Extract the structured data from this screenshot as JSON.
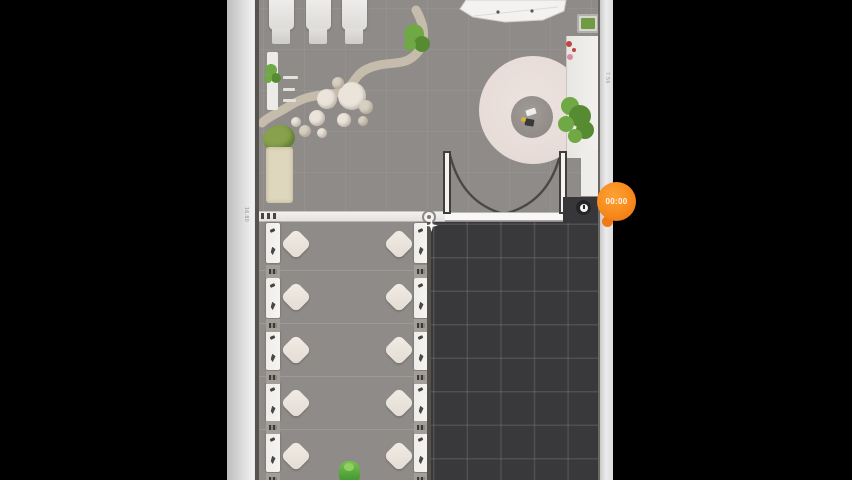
{
  "scene": {
    "name": "spa-salon-floor-plan"
  },
  "timer_badge": {
    "label": "00:00",
    "color": "#f88a1c",
    "color_dark": "#e96d10"
  },
  "dimensions": {
    "left_wall": "16.80",
    "right_wall": "7.56"
  },
  "colors": {
    "floor": "#8f8b89",
    "wall": "#e0e0e0",
    "locked_area": "#39393c",
    "locked_grid_line": "#5a5a60",
    "rug": "#e7dcd8",
    "path": "#c6bcab",
    "plant_green": "#6fa844",
    "character_green": "#5bb43e",
    "accent_orange": "#f88a1c"
  },
  "icons": {
    "clock": "clock-icon",
    "sparkle": "sparkle-icon",
    "lounger_marks": "lounger-figure-marks"
  },
  "furniture": {
    "treatment_tables": [
      {
        "x": 269
      },
      {
        "x": 306
      },
      {
        "x": 342
      }
    ],
    "pebbles": [
      [
        352,
        96,
        14,
        "A"
      ],
      [
        327,
        99,
        10,
        "A"
      ],
      [
        366,
        107,
        7,
        "B"
      ],
      [
        344,
        120,
        7,
        "A"
      ],
      [
        317,
        118,
        8,
        "A"
      ],
      [
        305,
        131,
        6,
        "B"
      ],
      [
        322,
        133,
        5,
        "A"
      ],
      [
        338,
        83,
        6,
        "B"
      ],
      [
        363,
        121,
        5,
        "B"
      ],
      [
        296,
        122,
        5,
        "A"
      ]
    ],
    "dining_tables": {
      "cols": [
        296,
        399
      ],
      "rows": [
        244,
        297,
        350,
        403,
        456
      ]
    },
    "loungers": {
      "left_x": 266,
      "right_x": 414,
      "rows": [
        223,
        278,
        330,
        382,
        432
      ],
      "gap_rows": [
        265,
        319,
        371,
        421,
        473
      ]
    },
    "shelf_dashes": [
      [
        283,
        76,
        15
      ],
      [
        283,
        88,
        12
      ],
      [
        283,
        99,
        13
      ]
    ],
    "counter_plant": [
      [
        570,
        106,
        9
      ],
      [
        580,
        116,
        11
      ],
      [
        566,
        124,
        8
      ],
      [
        585,
        130,
        9
      ],
      [
        575,
        136,
        7
      ]
    ],
    "path_plant": [
      [
        414,
        34,
        10
      ],
      [
        422,
        44,
        8
      ],
      [
        410,
        45,
        6
      ]
    ],
    "shelf_plant": [
      [
        271,
        70,
        6
      ],
      [
        276,
        78,
        5
      ],
      [
        268,
        79,
        4
      ]
    ],
    "red_items": [
      [
        569,
        44,
        3,
        "#c04545"
      ],
      [
        574,
        50,
        2,
        "#c04545"
      ],
      [
        570,
        57,
        3,
        "#d98ca0"
      ]
    ]
  }
}
